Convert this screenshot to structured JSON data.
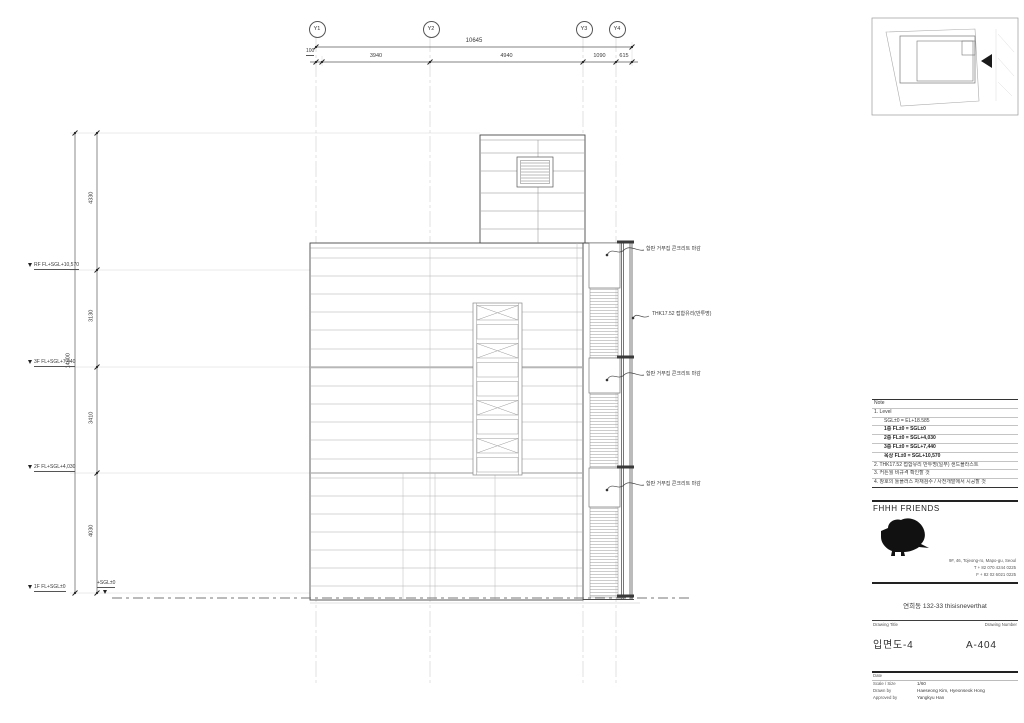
{
  "drawing": {
    "grid_bubbles": [
      "Y1",
      "Y2",
      "Y3",
      "Y4"
    ],
    "dims_top": {
      "overall": "10645",
      "seg_100": "100",
      "seg_3940": "3940",
      "seg_4940": "4940",
      "seg_1090": "1090",
      "seg_615": "615"
    },
    "dims_left": {
      "overall": "14900",
      "seg_top": "4330",
      "seg_rf_3f": "3130",
      "seg_3f_2f": "3410",
      "seg_2f_1f": "4030"
    },
    "levels": {
      "rf": "RF  FL+SGL+10,570",
      "f3": "3F  FL+SGL+7,440",
      "f2": "2F  FL+SGL+4,030",
      "f1": "1F  FL+SGL±0",
      "ground": "+SGL±0"
    },
    "callouts": {
      "concrete": "합판 거푸집 콘크리트 마감",
      "glass": "THK17.52 접합유리(반투명)"
    }
  },
  "titleblock": {
    "notes": {
      "header": "Note",
      "n1": "1.  Level",
      "n1_sub": "SGL±0 = EL+18.585",
      "lv1": "1층 FL±0 = SGL±0",
      "lv2": "2층 FL±0 = SGL+4,030",
      "lv3": "3층 FL±0 = SGL+7,440",
      "lv4": "옥상 FL±0 = SGL+10,570",
      "n2": "2.  THK17.52 접합유리 반투명(일부) 샌드블라스트",
      "n3": "3.  커튼월 비규격 확인할 것",
      "n4": "4.  창호의 툴플러스 자재검수 / 사전개발에서 시공할 것"
    },
    "firm": {
      "name": "FHHH FRIENDS",
      "address": "9F, 46, Tojeong-ro, Mapo-gu, Seoul",
      "tel": "T + 82 070 4244 0225",
      "fax": "F + 82 02 6021 0225"
    },
    "project": "연희동 132-33 thisisneverthat",
    "labels": {
      "drawing_title": "Drawing Title",
      "drawing_number": "Drawing Number",
      "date": "Date",
      "scale": "Scale / Size",
      "drawn": "Drawn by",
      "approved": "Approved by"
    },
    "values": {
      "title": "입면도-4",
      "number": "A-404",
      "scale": "1/60",
      "drawn": "Haeseong Kim, Hyeonseok Hong",
      "approved": "Yangkyu Han"
    }
  }
}
